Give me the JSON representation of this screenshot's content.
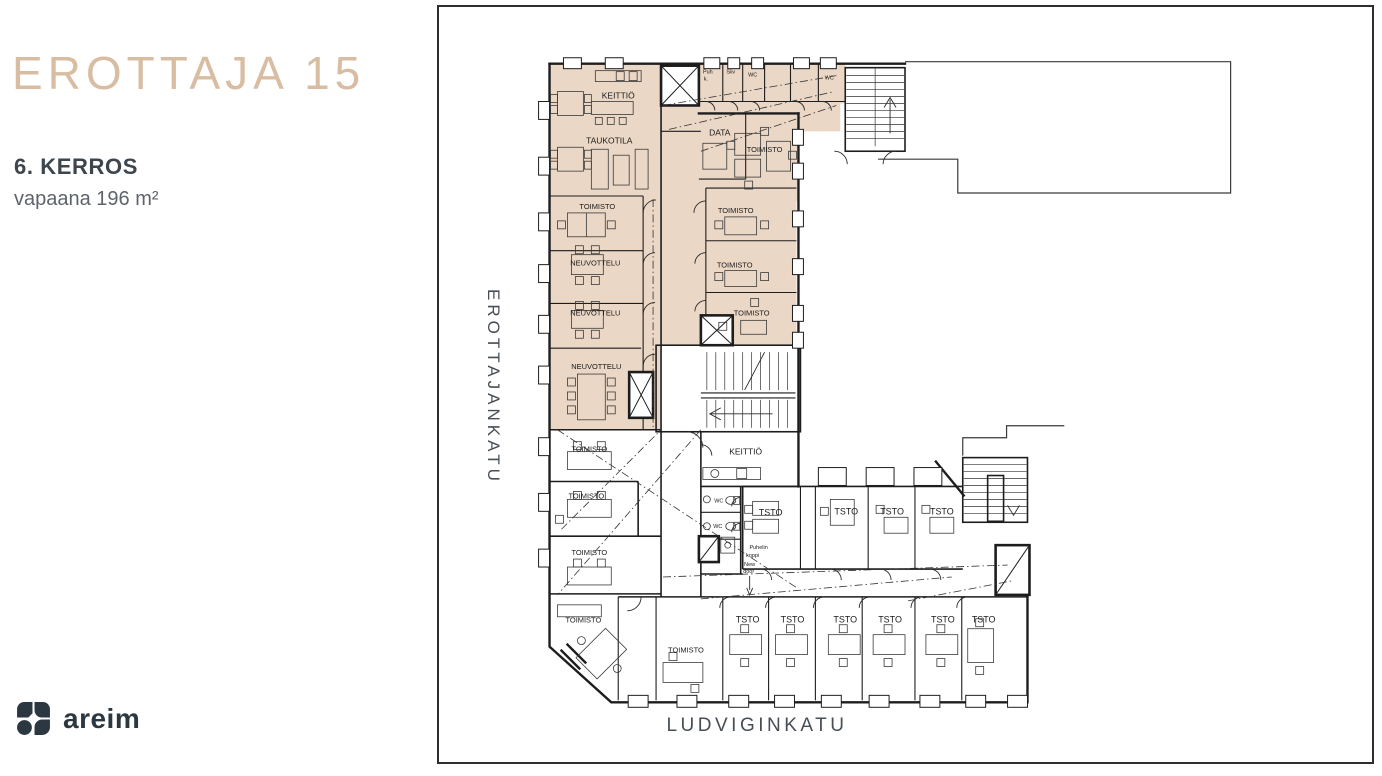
{
  "branding": {
    "wordmark": "EROTTAJA 15",
    "logo_text": "areim"
  },
  "header": {
    "floor_title": "6. KERROS",
    "availability": "vapaana 196 m²"
  },
  "streets": {
    "left": "EROTTAJANKATU",
    "bottom": "LUDVIGINKATU"
  },
  "colors": {
    "highlight": "#EAD7C5",
    "wordmark": "#D9BDA3",
    "heading": "#3D454D",
    "subheading": "#5D646C",
    "logo": "#2B3741",
    "wall": "#1D1D1D"
  },
  "plan": {
    "room_labels": [
      "KEITTIÖ",
      "TAUKOTILA",
      "Puh",
      "k.",
      "Siiv",
      "WC",
      "WC",
      "DATA",
      "TOIMISTO",
      "TOIMISTO",
      "NEUVOTTELU",
      "NEUVOTTELU",
      "NEUVOTTELU",
      "TOIMISTO",
      "TOIMISTO",
      "TOIMISTO",
      "TOIMISTO",
      "TOIMISTO",
      "TOIMISTO",
      "KEITTIÖ",
      "WC",
      "WC",
      "TSTO",
      "Puhelin",
      "koppi",
      "New",
      "door",
      "TSTO",
      "TSTO",
      "TSTO",
      "TOIMISTO",
      "TOIMISTO",
      "TSTO",
      "TSTO",
      "TSTO",
      "TSTO",
      "TSTO",
      "TSTO"
    ]
  }
}
